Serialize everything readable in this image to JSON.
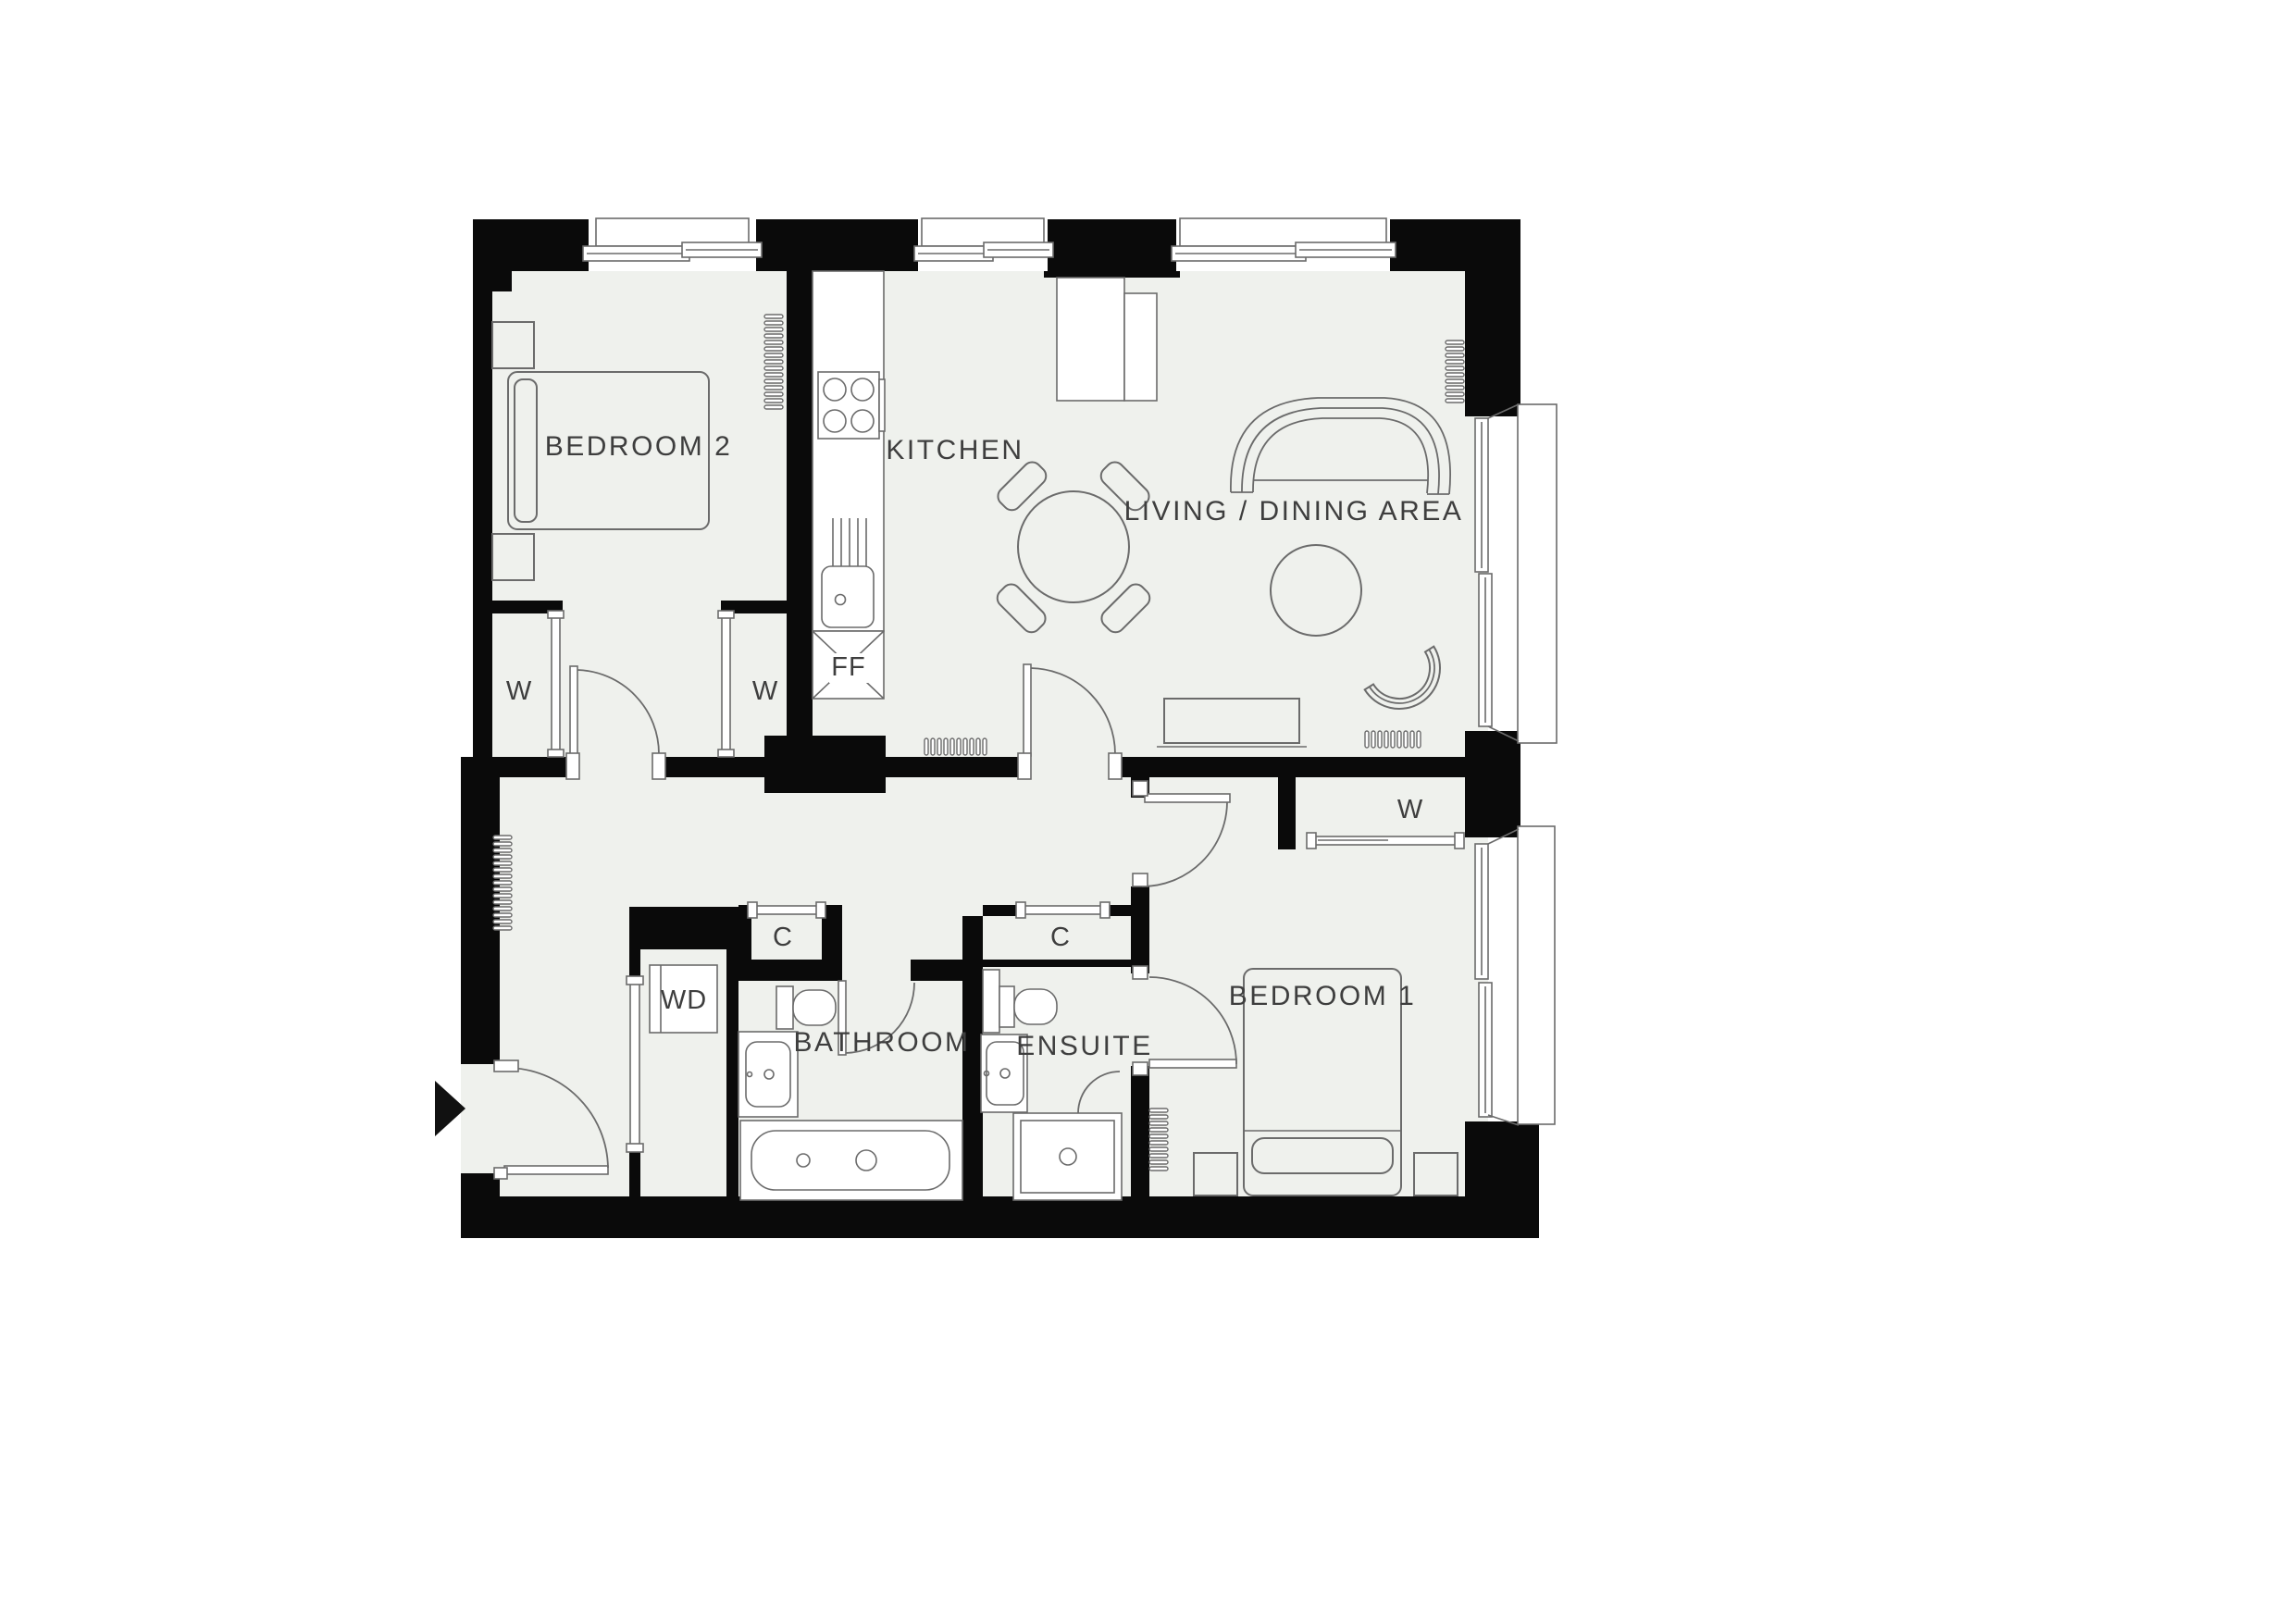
{
  "plan": {
    "title": "apartment-floor-plan",
    "rooms": {
      "bedroom2": "BEDROOM 2",
      "kitchen": "KITCHEN",
      "living": "LIVING / DINING AREA",
      "bedroom1": "BEDROOM 1",
      "bathroom": "BATHROOM",
      "ensuite": "ENSUITE"
    },
    "fixtures": {
      "wardrobe": "W",
      "cupboard": "C",
      "washer_dryer": "WD",
      "fridge_freezer": "FF"
    },
    "icons": {
      "entry_arrow": "right-pointing-triangle-entry-marker",
      "radiator": "coil-tick-strip",
      "door": "quarter-circle-swing-arc"
    },
    "colors": {
      "wall": "#0a0a0a",
      "floor": "#eff1ed",
      "line": "#6b6b6b",
      "label": "#3e3e3e",
      "background": "#ffffff"
    }
  }
}
